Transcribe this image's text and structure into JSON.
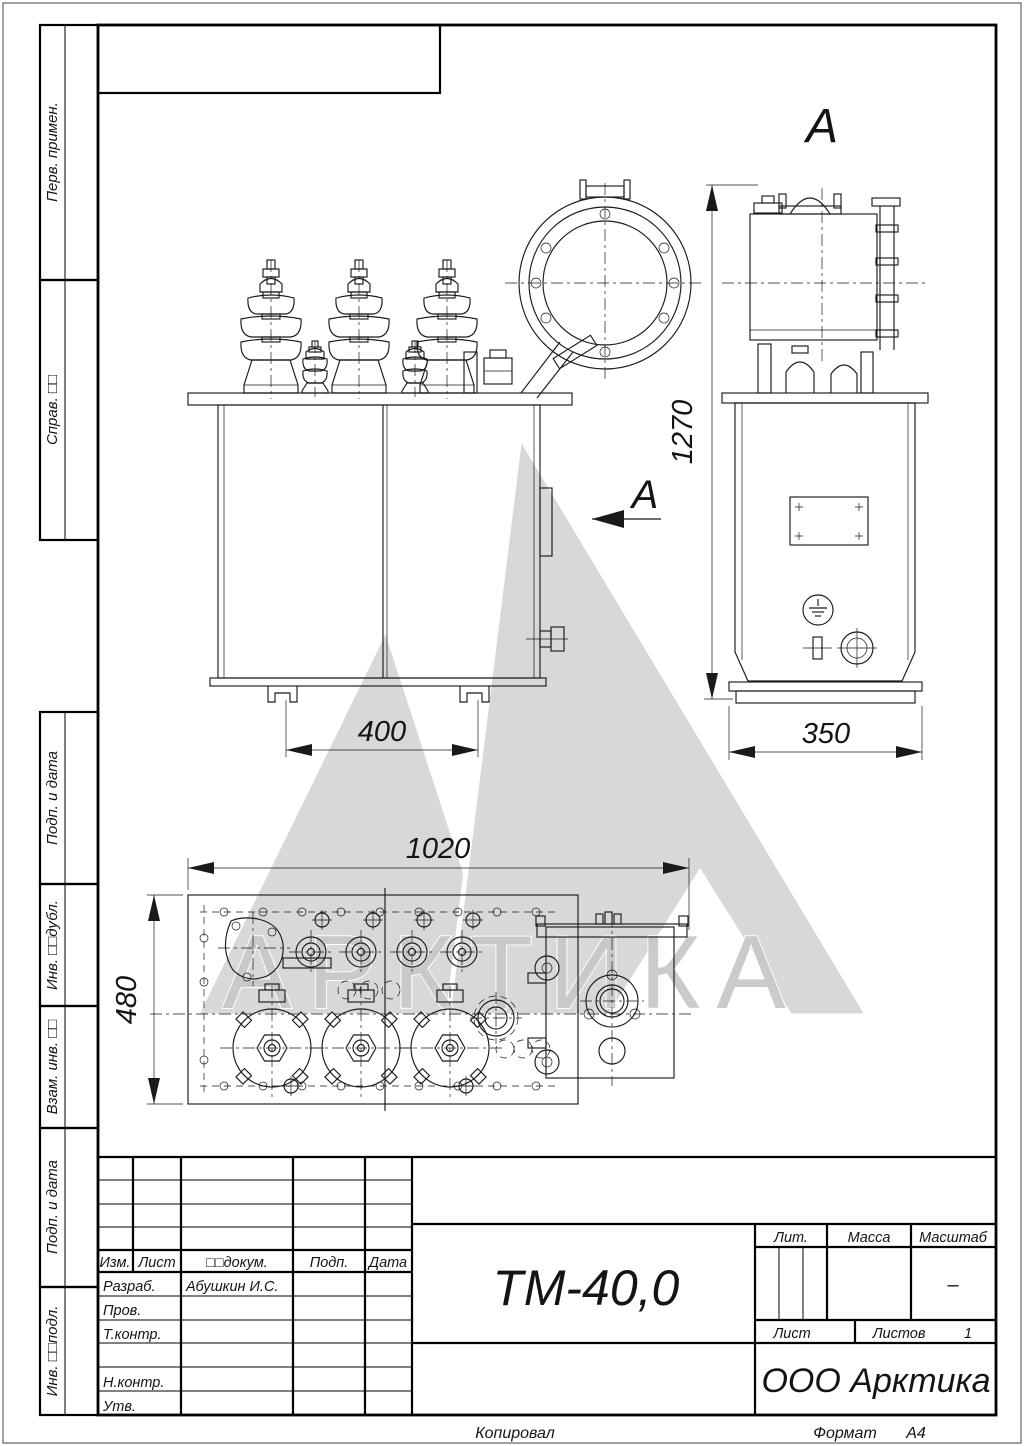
{
  "watermark": {
    "text": "АРКТИКА"
  },
  "views": {
    "view_label_top": "А",
    "view_label_arrow": "А"
  },
  "dimensions": {
    "front_base": "400",
    "side_base": "350",
    "height": "1270",
    "plan_length": "1020",
    "plan_width": "480"
  },
  "sidebar": {
    "perv_primen": "Перв. примен.",
    "sprav": "Справ. □□",
    "podp_data_1": "Подп. и дата",
    "inv_dubl": "Инв. □□дубл.",
    "vzam_inv": "Взам. инв. □□",
    "podp_data_2": "Подп. и дата",
    "inv_podl": "Инв. □□подл."
  },
  "title_block": {
    "designation": "ТМ-40,0",
    "company": "ООО Арктика",
    "col_izm": "Изм.",
    "col_list": "Лист",
    "col_dokum": "□□докум.",
    "col_podp": "Подп.",
    "col_data": "Дата",
    "rows": [
      {
        "label": "Разраб.",
        "value": "Абушкин И.С."
      },
      {
        "label": "Пров.",
        "value": ""
      },
      {
        "label": "Т.контр.",
        "value": ""
      },
      {
        "label": "",
        "value": ""
      },
      {
        "label": "Н.контр.",
        "value": ""
      },
      {
        "label": "Утв.",
        "value": ""
      }
    ],
    "lit": "Лит.",
    "massa": "Масса",
    "masshtab": "Масштаб",
    "masshtab_value": "–",
    "list": "Лист",
    "listov": "Листов",
    "listov_value": "1"
  },
  "footer": {
    "kopiroval": "Копировал",
    "format_label": "Формат",
    "format_value": "А4"
  }
}
